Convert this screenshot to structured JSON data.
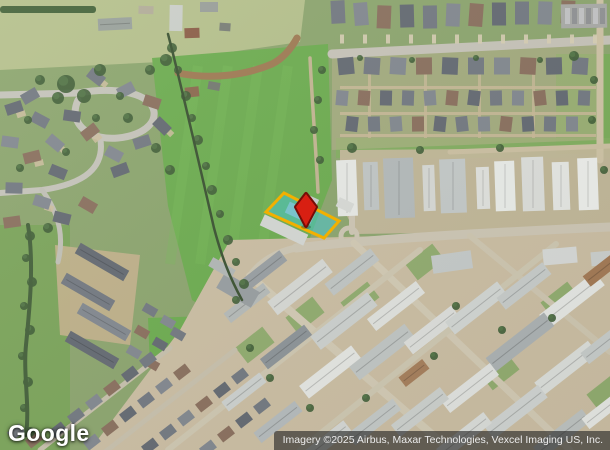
{
  "map": {
    "watermark_text": "Google",
    "attribution_text": "Imagery ©2025 Airbus, Maxar Technologies, Vexcel Imaging US, Inc."
  },
  "parcel_overlay": {
    "fill_color": "rgba(68,199,214,0.5)",
    "outline_color": "#f2b000"
  },
  "marker": {
    "fill_color": "#d81f12",
    "outline_color": "#750d06"
  }
}
